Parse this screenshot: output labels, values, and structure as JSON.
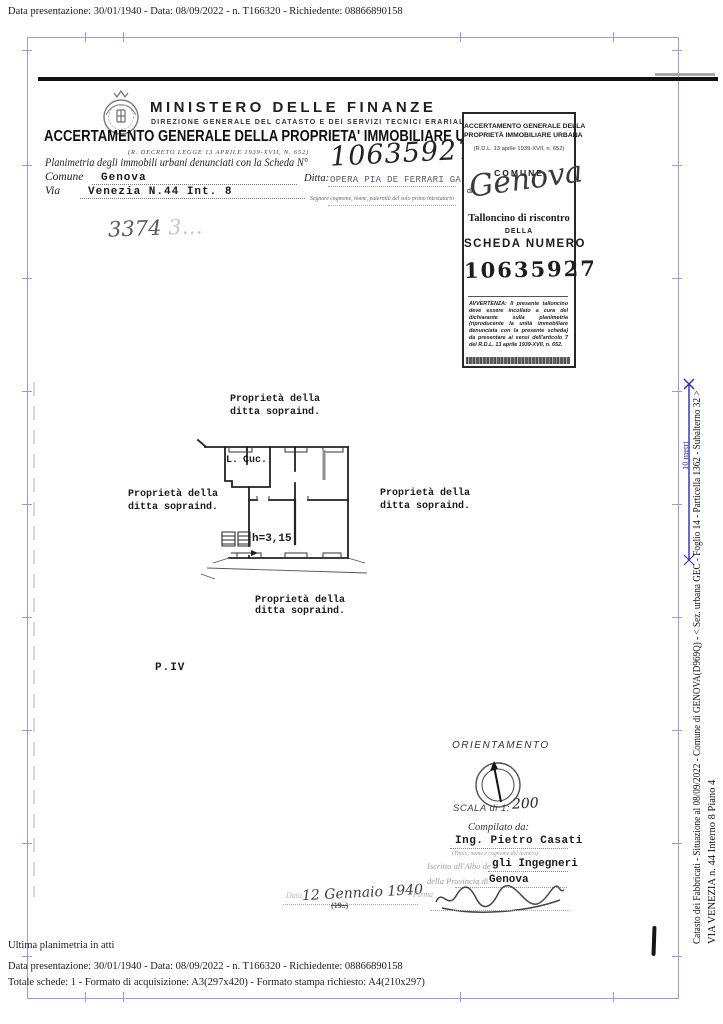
{
  "meta": {
    "top_line": "Data presentazione: 30/01/1940 - Data: 08/09/2022 - n. T166320 - Richiedente: 08866890158",
    "status_line": "Ultima planimetria in atti",
    "bottom_line1": "Data presentazione: 30/01/1940 - Data: 08/09/2022 - n. T166320 - Richiedente: 08866890158",
    "bottom_line2": "Totale schede: 1 - Formato di acquisizione: A3(297x420)  - Formato stampa richiesto: A4(210x297)"
  },
  "header": {
    "ministry": "MINISTERO DELLE FINANZE",
    "direction": "DIREZIONE GENERALE DEL CATASTO E DEI SERVIZI TECNICI ERARIALI",
    "title": "ACCERTAMENTO GENERALE DELLA PROPRIETA' IMMOBILIARE URBANA",
    "decree": "(R. DECRETO LEGGE 13 APRILE 1939-XVII, N. 652)"
  },
  "form": {
    "scheda_label": "Planimetria degli immobili urbani denunciati con la Scheda N°",
    "scheda_number_hw": "10635927",
    "comune_label": "Comune",
    "comune_value": "Genova",
    "ditta_label": "Ditta:",
    "ditta_value": "OPERA PIA DE FERRARI GALLIERA",
    "via_label": "Via",
    "via_value": "Venezia N.44 Int. 8",
    "ditta_note": "Segnare cognome, nome, paternità del solo primo intestatario",
    "hw_ref_dark": "3374",
    "hw_ref_faint": "3…"
  },
  "talloncino": {
    "title1": "ACCERTAMENTO GENERALE DELLA",
    "title2": "PROPRIETÀ IMMOBILIARE URBANA",
    "decree": "(R.D.L. 13 aprile 1939-XVII, n. 652)",
    "comune_label": "COMUNE",
    "di_label": "di",
    "comune_hw": "Genova",
    "line1": "Talloncino di riscontro",
    "line2": "DELLA",
    "line3": "SCHEDA NUMERO",
    "number": "10635927",
    "avvertenza": "AVVERTENZA: Il presente talloncino deve essere incollato a cura del dichiarante sulla planimetria (riproducente la unità immobiliare denunciata con la presente scheda) da presentare ai sensi dell'articolo 7 del R.D.L. 13 aprile 1939-XVII, n. 652."
  },
  "plan": {
    "prop1": "Proprietà della",
    "prop2": "ditta sopraind.",
    "room_l": "L.",
    "room_cuc": "Cuc.",
    "height_note": "h=3,15",
    "floor": "P.IV"
  },
  "orientation": {
    "title": "ORIENTAMENTO",
    "scala_label": "SCALA di 1:",
    "scala_value": "200"
  },
  "compilato": {
    "label": "Compilato da:",
    "name": "Ing. Pietro Casati",
    "name_note": "(Titolo, nome e cognome del tecnico)",
    "albo_label": "Iscritto all'Albo de",
    "albo_value": "gli Ingegneri",
    "provincia_label": "della Provincia di",
    "provincia_value": "Genova",
    "data_label": "Data",
    "date_hw": "12 Gennaio 1940",
    "year_print": "(19..)",
    "firma_label": "Firma"
  },
  "margin": {
    "vertical_line1": "Catasto dei Fabbricati - Situazione al 08/09/2022 - Comune di GENOVA(D969Q) - < Sez. urbana GEC - Foglio 14 - Particella 1362 - Subalterno 32 >",
    "vertical_line2": "VIA VENEZIA n. 44 Interno 8 Piano 4",
    "ruler_label": "10 metri"
  },
  "colors": {
    "frame": "#9a9ae2",
    "ruler_blue": "#2b2bbf",
    "ink": "#1b1b1b"
  }
}
